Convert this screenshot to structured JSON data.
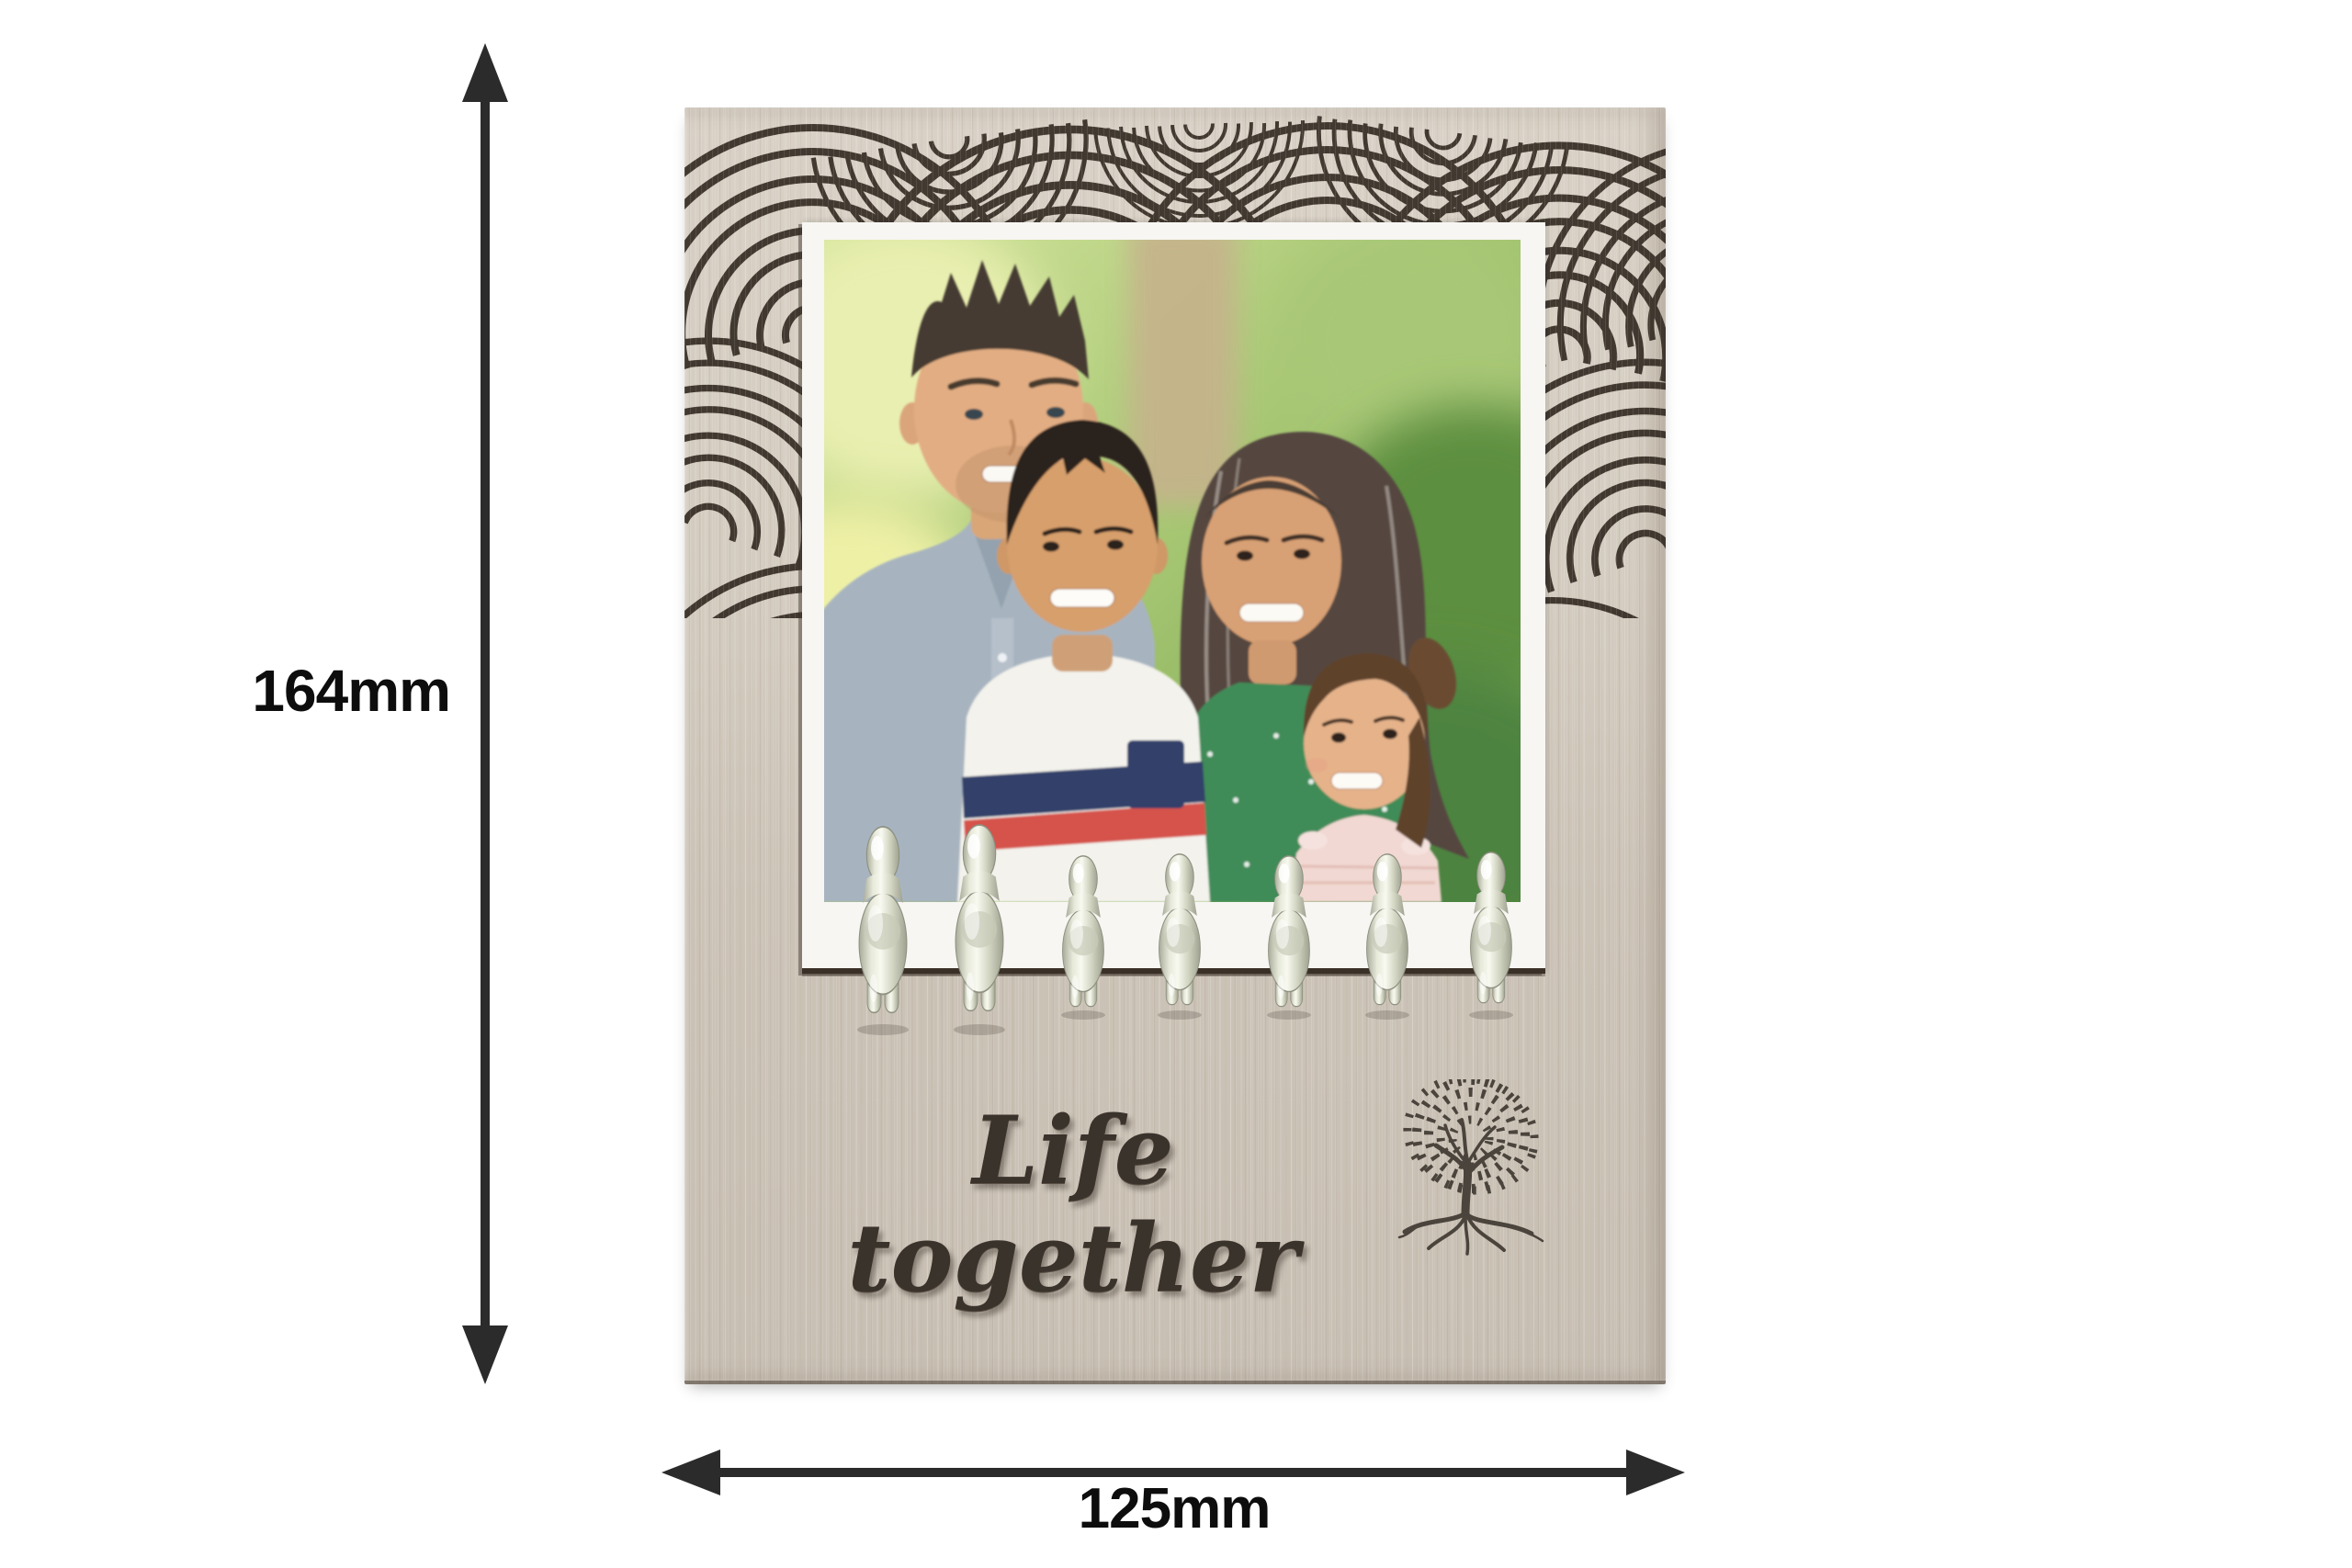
{
  "page": {
    "background": "#ffffff"
  },
  "dimensions": {
    "height_label": "164mm",
    "width_label": "125mm",
    "arrow_color": "#2b2b2b"
  },
  "frame": {
    "engraving_text": "Life together",
    "motif": "tree-of-life",
    "figurines": {
      "count": 7,
      "adults": 2,
      "children": 5,
      "finish": "polished silver"
    },
    "colors": {
      "wood": "#cfc6ba",
      "wood_light": "#d9d1c6",
      "pattern_ink": "#362e25",
      "mat": "#f7f6f2",
      "mat_edge": "#3a3027",
      "engraving_ink": "#3a332c",
      "tree_ink": "#4a443c",
      "figurine_silver": "#e9ebdd"
    }
  },
  "photo": {
    "alt": "Family of four - father, son, mother and daughter - smiling together outdoors against a green bokeh background"
  }
}
